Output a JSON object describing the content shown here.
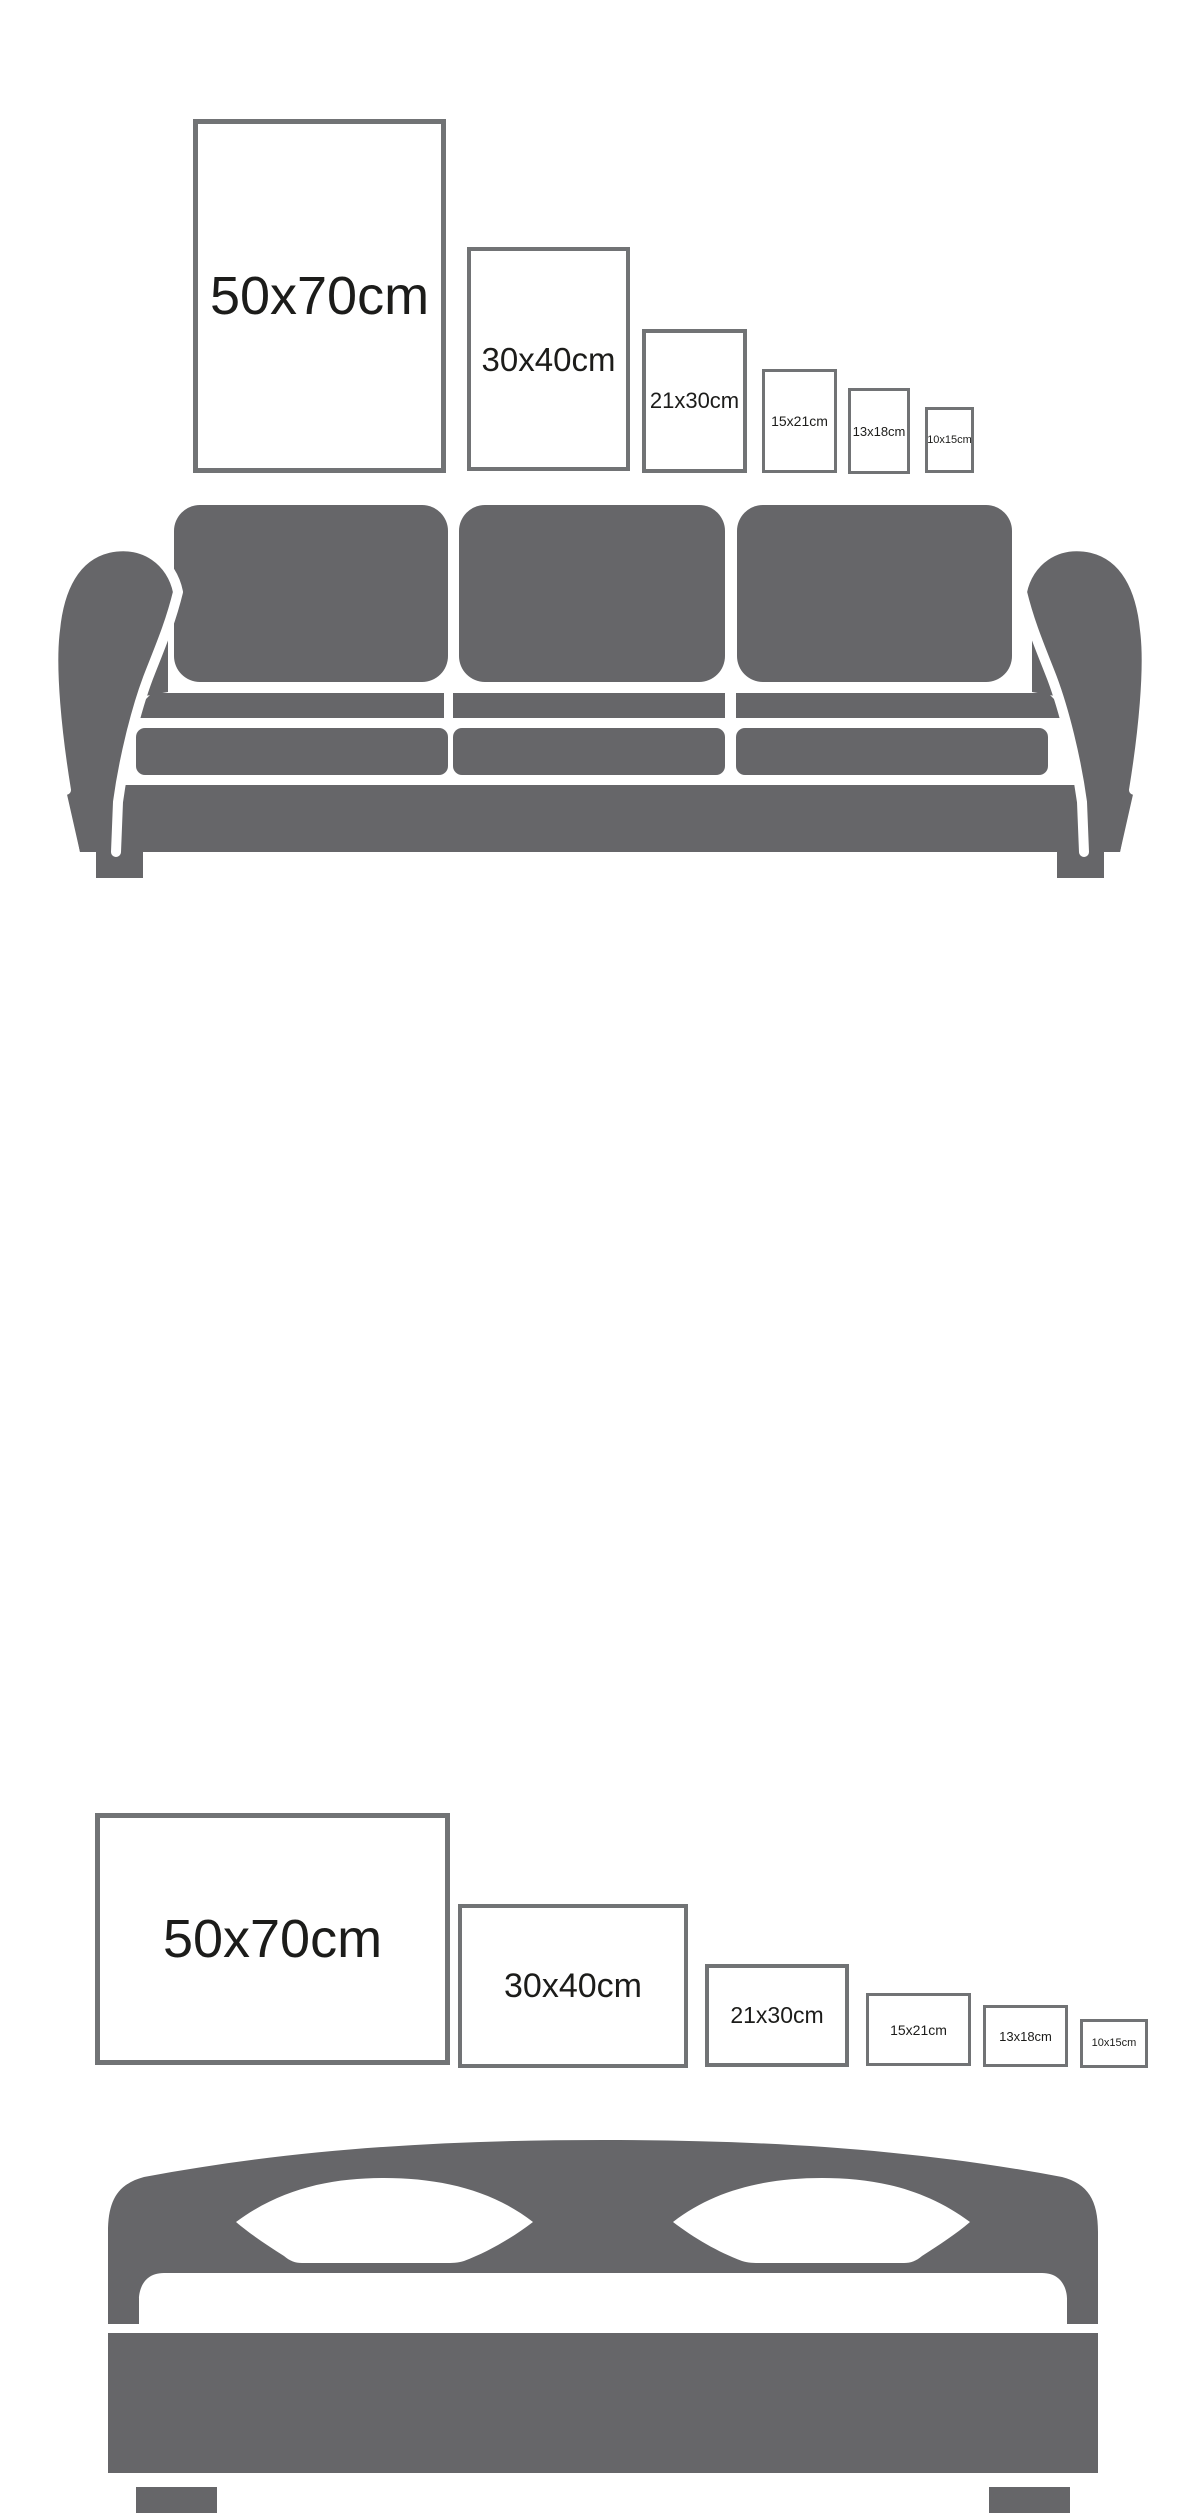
{
  "page": {
    "type": "poster-size-guide-infographic",
    "background": "#ffffff"
  },
  "colors": {
    "furniture_gray": "#666669",
    "frame_border": "#717375",
    "label_text": "#1c1c1a"
  },
  "sections": [
    {
      "id": "sofa-comparison",
      "furniture": "sofa",
      "orientation": "portrait",
      "frames": [
        {
          "label": "50x70cm"
        },
        {
          "label": "30x40cm"
        },
        {
          "label": "21x30cm"
        },
        {
          "label": "15x21cm"
        },
        {
          "label": "13x18cm"
        },
        {
          "label": "10x15cm"
        }
      ]
    },
    {
      "id": "bed-comparison",
      "furniture": "bed",
      "orientation": "landscape",
      "frames": [
        {
          "label": "50x70cm"
        },
        {
          "label": "30x40cm"
        },
        {
          "label": "21x30cm"
        },
        {
          "label": "15x21cm"
        },
        {
          "label": "13x18cm"
        },
        {
          "label": "10x15cm"
        }
      ]
    }
  ]
}
